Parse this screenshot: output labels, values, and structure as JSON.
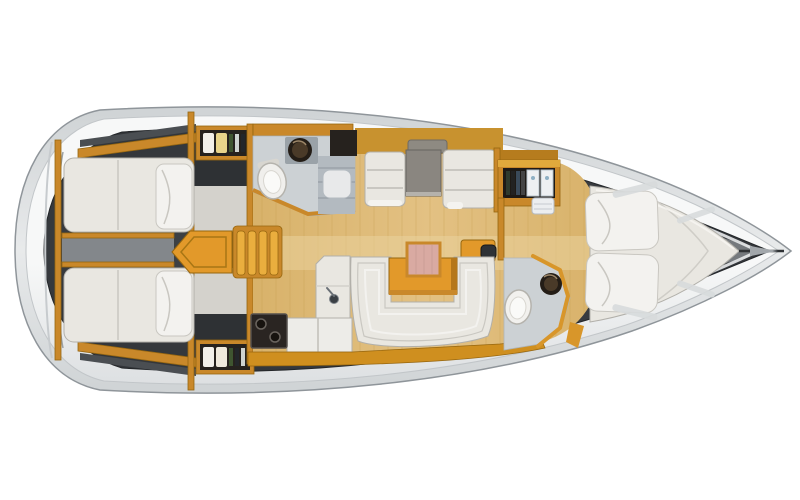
{
  "background": "#ffffff",
  "palette": {
    "hull_outline": "#8f959a",
    "hull_fill_light": "#e8eaeb",
    "hull_fill": "#cfd3d5",
    "deck_light": "#f7f8f8",
    "deck_dark": "#dde0e2",
    "deck_stroke": "#c2c6c9",
    "interior_dark": "#2c2f33",
    "interior_mid": "#46494d",
    "cabinetry": "#c9882a",
    "cabinetry_bright": "#e2992a",
    "cabinetry_light": "#eaae3e",
    "cabinetry_dark": "#96660f",
    "floor_tan": "#d8b26a",
    "floor_tan_light": "#e3c183",
    "floor_light": "#e9d29c",
    "plank": "#c49a4e",
    "upholstery": "#e9e7e1",
    "upholstery_bright": "#f3f2ef",
    "upholstery_stroke": "#b2b0aa",
    "upholstery_trim": "#c9c7c1",
    "head_floor": "#ccd1d4",
    "counter_gray": "#b3bac0",
    "counter_gray_dark": "#9aa2a8",
    "table_gray": "#8a8680",
    "table_pink": "#d9aaa2",
    "appliance_dark": "#2a2522",
    "sink_outer": "#241d16",
    "sink_inner": "#4a3a28",
    "storage_dark": "#26221e",
    "dark_panel": "#2e3134",
    "divider_gray": "#83878b",
    "shirt_white": "#f2f0ea",
    "shirt_yellow": "#e8d48a",
    "bottle_green": "#3f5530"
  },
  "vessel": {
    "view": "top-down interior floor plan of a sailing yacht",
    "bow_direction": "right",
    "stern_direction": "left",
    "areas": [
      {
        "name": "aft-cabin-starboard",
        "features": [
          "double-berth",
          "pillow",
          "wardrobe-with-clothes"
        ]
      },
      {
        "name": "aft-cabin-port",
        "features": [
          "double-berth",
          "pillow",
          "wardrobe-with-clothes"
        ]
      },
      {
        "name": "companionway",
        "features": [
          "steps",
          "engine-box"
        ]
      },
      {
        "name": "aft-head",
        "features": [
          "toilet",
          "round-sink",
          "counter-with-shelves",
          "basin"
        ]
      },
      {
        "name": "galley",
        "features": [
          "sink-with-faucet",
          "two-burner-stove",
          "refrigerator-counter"
        ]
      },
      {
        "name": "salon",
        "features": [
          "u-shaped-settee",
          "table-with-folding-leaf",
          "storage-chest"
        ]
      },
      {
        "name": "nav-dinette",
        "features": [
          "facing-settees",
          "chart-table",
          "overhead-locker",
          "shelf-with-hatch"
        ]
      },
      {
        "name": "forward-head",
        "features": [
          "toilet",
          "round-sink",
          "angled-partition"
        ]
      },
      {
        "name": "forward-cabin",
        "features": [
          "v-berth",
          "two-pillows",
          "bookshelf",
          "small-locker"
        ]
      }
    ]
  }
}
